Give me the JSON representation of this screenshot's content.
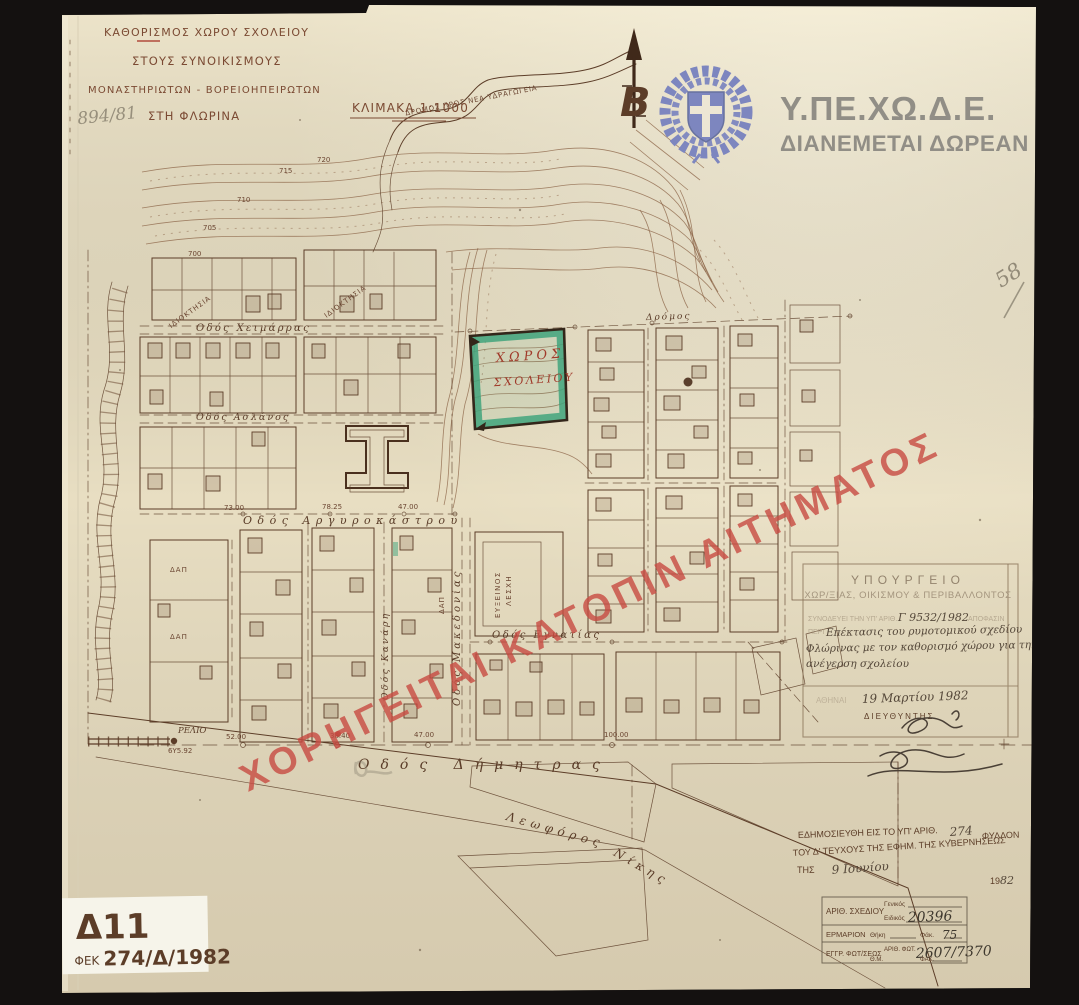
{
  "paper": {
    "bg": "#e8dec2",
    "ink": "#5c3d28",
    "accent_red": "#c84b42",
    "highlight_green": "#3fa47c",
    "emblem_blue": "#7d86bf"
  },
  "title_block": {
    "line1": "ΚΑΘΟΡΙΣΜΟΣ ΧΩΡΟΥ ΣΧΟΛΕΙΟΥ",
    "line2": "ΣΤΟΥΣ ΣΥΝΟΙΚΙΣΜΟΥΣ",
    "line3": "ΜΟΝΑΣΤΗΡΙΩΤΩΝ - ΒΟΡΕΙΟΗΠΕΙΡΩΤΩΝ",
    "line4": "ΣΤΗ ΦΛΩΡΙΝΑ",
    "scale_label": "ΚΛΙΜΑΚΑ 1:1000"
  },
  "agency": {
    "name": "Υ.ΠΕ.ΧΩ.Δ.Ε.",
    "distribution": "ΔΙΑΝΕΜΕΤΑΙ ΔΩΡΕΑΝ"
  },
  "watermark": {
    "text": "ΧΟΡΗΓΕΙΤΑΙ ΚΑΤΟΠΙΝ ΑΙΤΗΜΑΤΟΣ"
  },
  "pencil_notes": {
    "top_left": "894/81",
    "right_edge": "58"
  },
  "map": {
    "north_label": "Β",
    "road_note": "ΔΡΟΜΟΣ ΠΡΟΣ ΝΕΑ ΥΔΡΑΓΩΓΕΙΑ",
    "school_site": {
      "line1": "ΧΩΡΟΣ",
      "line2": "ΣΧΟΛΕΙΟΥ"
    },
    "streets": {
      "chimarras": "Οδός Χειμάρρας",
      "aslanos": "Οδός Ασλάνος",
      "argyrokastrou": "Οδός Αργυροκάστρου",
      "kanari": "Οδός Κανάρη",
      "makedonias": "Οδός Μακεδονίας",
      "egnatias": "Οδός Εγνατίας",
      "dimitras": "Οδός Δήμητρας",
      "leoforos": "Λεωφόρος",
      "nikis": "Νίκης",
      "dromos": "Δρόμος"
    },
    "labels": {
      "dap": "ΔΑΠ",
      "efxinos_line1": "ΕΥΞΕΙΝΟΣ",
      "efxinos_line2": "ΛΕΣΧΗ",
      "idioktisia": "ΙΔΙΟΚΤΗΣΙΑ",
      "relio": "ΡΕΛΙΟ",
      "benchmark": "6Υ5.92"
    },
    "elevations": {
      "e700": "700",
      "e705": "705",
      "e710": "710",
      "e715": "715",
      "e720": "720"
    },
    "dimensions": {
      "d52": "52.00",
      "d3840": "38.40",
      "d47": "47.00",
      "d100": "100.00",
      "d7825": "78.25",
      "d73": "73.00"
    }
  },
  "ministry_stamp": {
    "line1": "ΥΠΟΥΡΓΕΙΟ",
    "line2": "ΧΩΡ/ΞΙΑΣ, ΟΙΚΙΣΜΟΥ & ΠΕΡΙΒΑΛΛΟΝΤΟΣ",
    "ref_prefix": "ΣΥΝΟΔΕΥΕΙ ΤΗΝ ΥΠ' ΑΡΙΘ.",
    "ref_number": "Γ 9532/1982",
    "ref_suffix": "ΑΠΟΦΑΣΙΝ",
    "peri": "ΠΕΡΙ",
    "subject_line1": "Επέκτασις του ρυμοτομικού σχεδίου",
    "subject_line2": "Φλώρινας με τον καθορισμό χώρου για την",
    "subject_line3": "ανέγερση σχολείου",
    "place": "ΑΘΗΝΑΙ",
    "date": "19 Μαρτίου 1982",
    "director": "ΔΙΕΥΘΥΝΤΗΣ",
    "signature": "(δυσανάγνωστη υπογραφή)"
  },
  "publication_note": {
    "line1_prefix": "ΕΔΗΜΟΣΙΕΥΘΗ ΕΙΣ ΤΟ ΥΠ' ΑΡΙΘ.",
    "sheet_number": "274",
    "line1_suffix": "ΦΥΛΛΟΝ",
    "line2": "ΤΟΥ Δ' ΤΕΥΧΟΥΣ ΤΗΣ ΕΦΗΜ. ΤΗΣ ΚΥΒΕΡΝΗΣΕΩΣ",
    "line3_prefix": "ΤΗΣ",
    "date_hand": "9 Ιουνίου",
    "year_print": "19",
    "year_hand": "82"
  },
  "archive_box": {
    "row1_label": "ΑΡΙΘ. ΣΧΕΔΙΟΥ",
    "genikos_label": "Γενικός",
    "eidikos_label": "Ειδικός",
    "eidikos_value": "20396",
    "row2_label": "ΕΡΜΑΡΙΟΝ",
    "thiki_label": "Θήκη",
    "fak_label": "Φάκ.",
    "fak_value": "75",
    "row3_label": "ΕΓΓΡ. ΦΩΤ/ΣΕΩΣ",
    "arith_fot_label": "ΑΡΙΘ. ΦΩΤ.",
    "fot_value": "2607/7370",
    "thm_label": "Θ.Μ.",
    "fak2_label": "ΦΑΚ."
  },
  "fek_label": {
    "code": "Δ11",
    "prefix": "ΦΕΚ",
    "number": "274/Δ/1982"
  }
}
